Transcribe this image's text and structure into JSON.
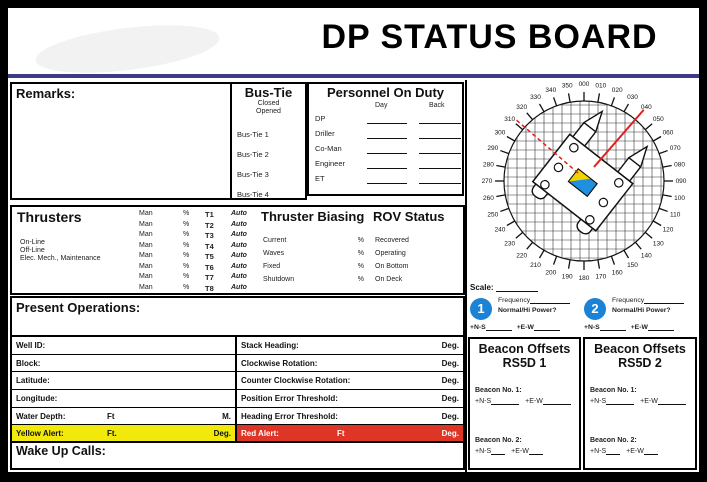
{
  "title": "DP STATUS BOARD",
  "remarks": {
    "label": "Remarks:"
  },
  "bus_tie": {
    "header": "Bus-Tie",
    "sub": [
      "Closed",
      "Opened"
    ],
    "rows": [
      "Bus-Tie 1",
      "Bus-Tie 2",
      "Bus-Tie 3",
      "Bus-Tie 4"
    ]
  },
  "personnel": {
    "header": "Personnel On Duty",
    "columns": [
      "Day",
      "Back"
    ],
    "rows": [
      "DP",
      "Driller",
      "Co-Man",
      "Engineer",
      "ET"
    ]
  },
  "thrusters": {
    "header": "Thrusters",
    "status_lines": [
      "On-Line",
      "Off-Line",
      "Elec. Mech., Maintenance"
    ],
    "table": {
      "col_man": "Man",
      "col_pct": "%",
      "col_auto": "Auto",
      "ids": [
        "T1",
        "T2",
        "T3",
        "T4",
        "T5",
        "T6",
        "T7",
        "T8"
      ]
    }
  },
  "thruster_biasing": {
    "header": "Thruster Biasing",
    "rows": [
      {
        "label": "Current",
        "unit": "%"
      },
      {
        "label": "Waves",
        "unit": "%"
      },
      {
        "label": "Fixed",
        "unit": "%"
      },
      {
        "label": "Shutdown",
        "unit": "%"
      }
    ]
  },
  "rov_status": {
    "header": "ROV Status",
    "rows": [
      "Recovered",
      "Operating",
      "On Bottom",
      "On Deck"
    ]
  },
  "present_operations": {
    "label": "Present Operations:"
  },
  "well_table": {
    "rows": [
      {
        "label": "Well ID:"
      },
      {
        "label": "Block:"
      },
      {
        "label": "Latitude:"
      },
      {
        "label": "Longitude:"
      },
      {
        "label": "Water Depth:",
        "mid": "Ft",
        "right": "M."
      },
      {
        "label": "Yellow Alert:",
        "mid": "Ft.",
        "right": "Deg.",
        "highlight": "yellow"
      }
    ]
  },
  "ops_table": {
    "rows": [
      {
        "label": "Stack Heading:",
        "right": "Deg."
      },
      {
        "label": "Clockwise Rotation:",
        "right": "Deg."
      },
      {
        "label": "Counter Clockwise Rotation:",
        "right": "Deg."
      },
      {
        "label": "Position Error Threshold:",
        "right": "Deg."
      },
      {
        "label": "Heading Error Threshold:",
        "right": "Deg."
      },
      {
        "label": "Red Alert:",
        "mid": "Ft",
        "right": "Deg.",
        "highlight": "red"
      }
    ]
  },
  "wake_up_calls": {
    "label": "Wake Up Calls:"
  },
  "compass": {
    "scale_label": "Scale:",
    "degree_step": 10,
    "labels": [
      "000",
      "010",
      "020",
      "030",
      "040",
      "050",
      "060",
      "070",
      "080",
      "090",
      "100",
      "110",
      "120",
      "130",
      "140",
      "150",
      "160",
      "170",
      "180",
      "190",
      "200",
      "210",
      "220",
      "230",
      "240",
      "250",
      "260",
      "270",
      "280",
      "290",
      "300",
      "310",
      "320",
      "330",
      "340",
      "350"
    ],
    "heading_deg": 38
  },
  "beacon_quick": [
    {
      "number": "1",
      "line1": "Frequency",
      "line2": "Normal/Hi Power?",
      "ns": "+N-S",
      "ew": "+E-W"
    },
    {
      "number": "2",
      "line1": "Frequency",
      "line2": "Normal/Hi Power?",
      "ns": "+N-S",
      "ew": "+E-W"
    }
  ],
  "beacon_offsets": [
    {
      "title": "Beacon Offsets",
      "subtitle": "RS5D 1",
      "entries": [
        {
          "label": "Beacon No. 1:",
          "ns": "+N-S",
          "ew": "+E-W",
          "blank": true
        },
        {
          "label": "Beacon No. 2:",
          "ns": "+N-S",
          "ew": "+E-W",
          "blank": false
        }
      ]
    },
    {
      "title": "Beacon Offsets",
      "subtitle": "RS5D 2",
      "entries": [
        {
          "label": "Beacon No. 1:",
          "ns": "+N-S",
          "ew": "+E-W",
          "blank": true
        },
        {
          "label": "Beacon No. 2:",
          "ns": "+N-S",
          "ew": "+E-W",
          "blank": false
        }
      ]
    }
  ],
  "colors": {
    "yellow_alert": "#f2e90c",
    "red_alert": "#dd3526",
    "navy_rule": "#3c3c85",
    "beacon_blue": "#1b82d6",
    "flag_yellow": "#f2d500",
    "flag_blue": "#1f8fe0",
    "bearing_red": "#e02020"
  }
}
